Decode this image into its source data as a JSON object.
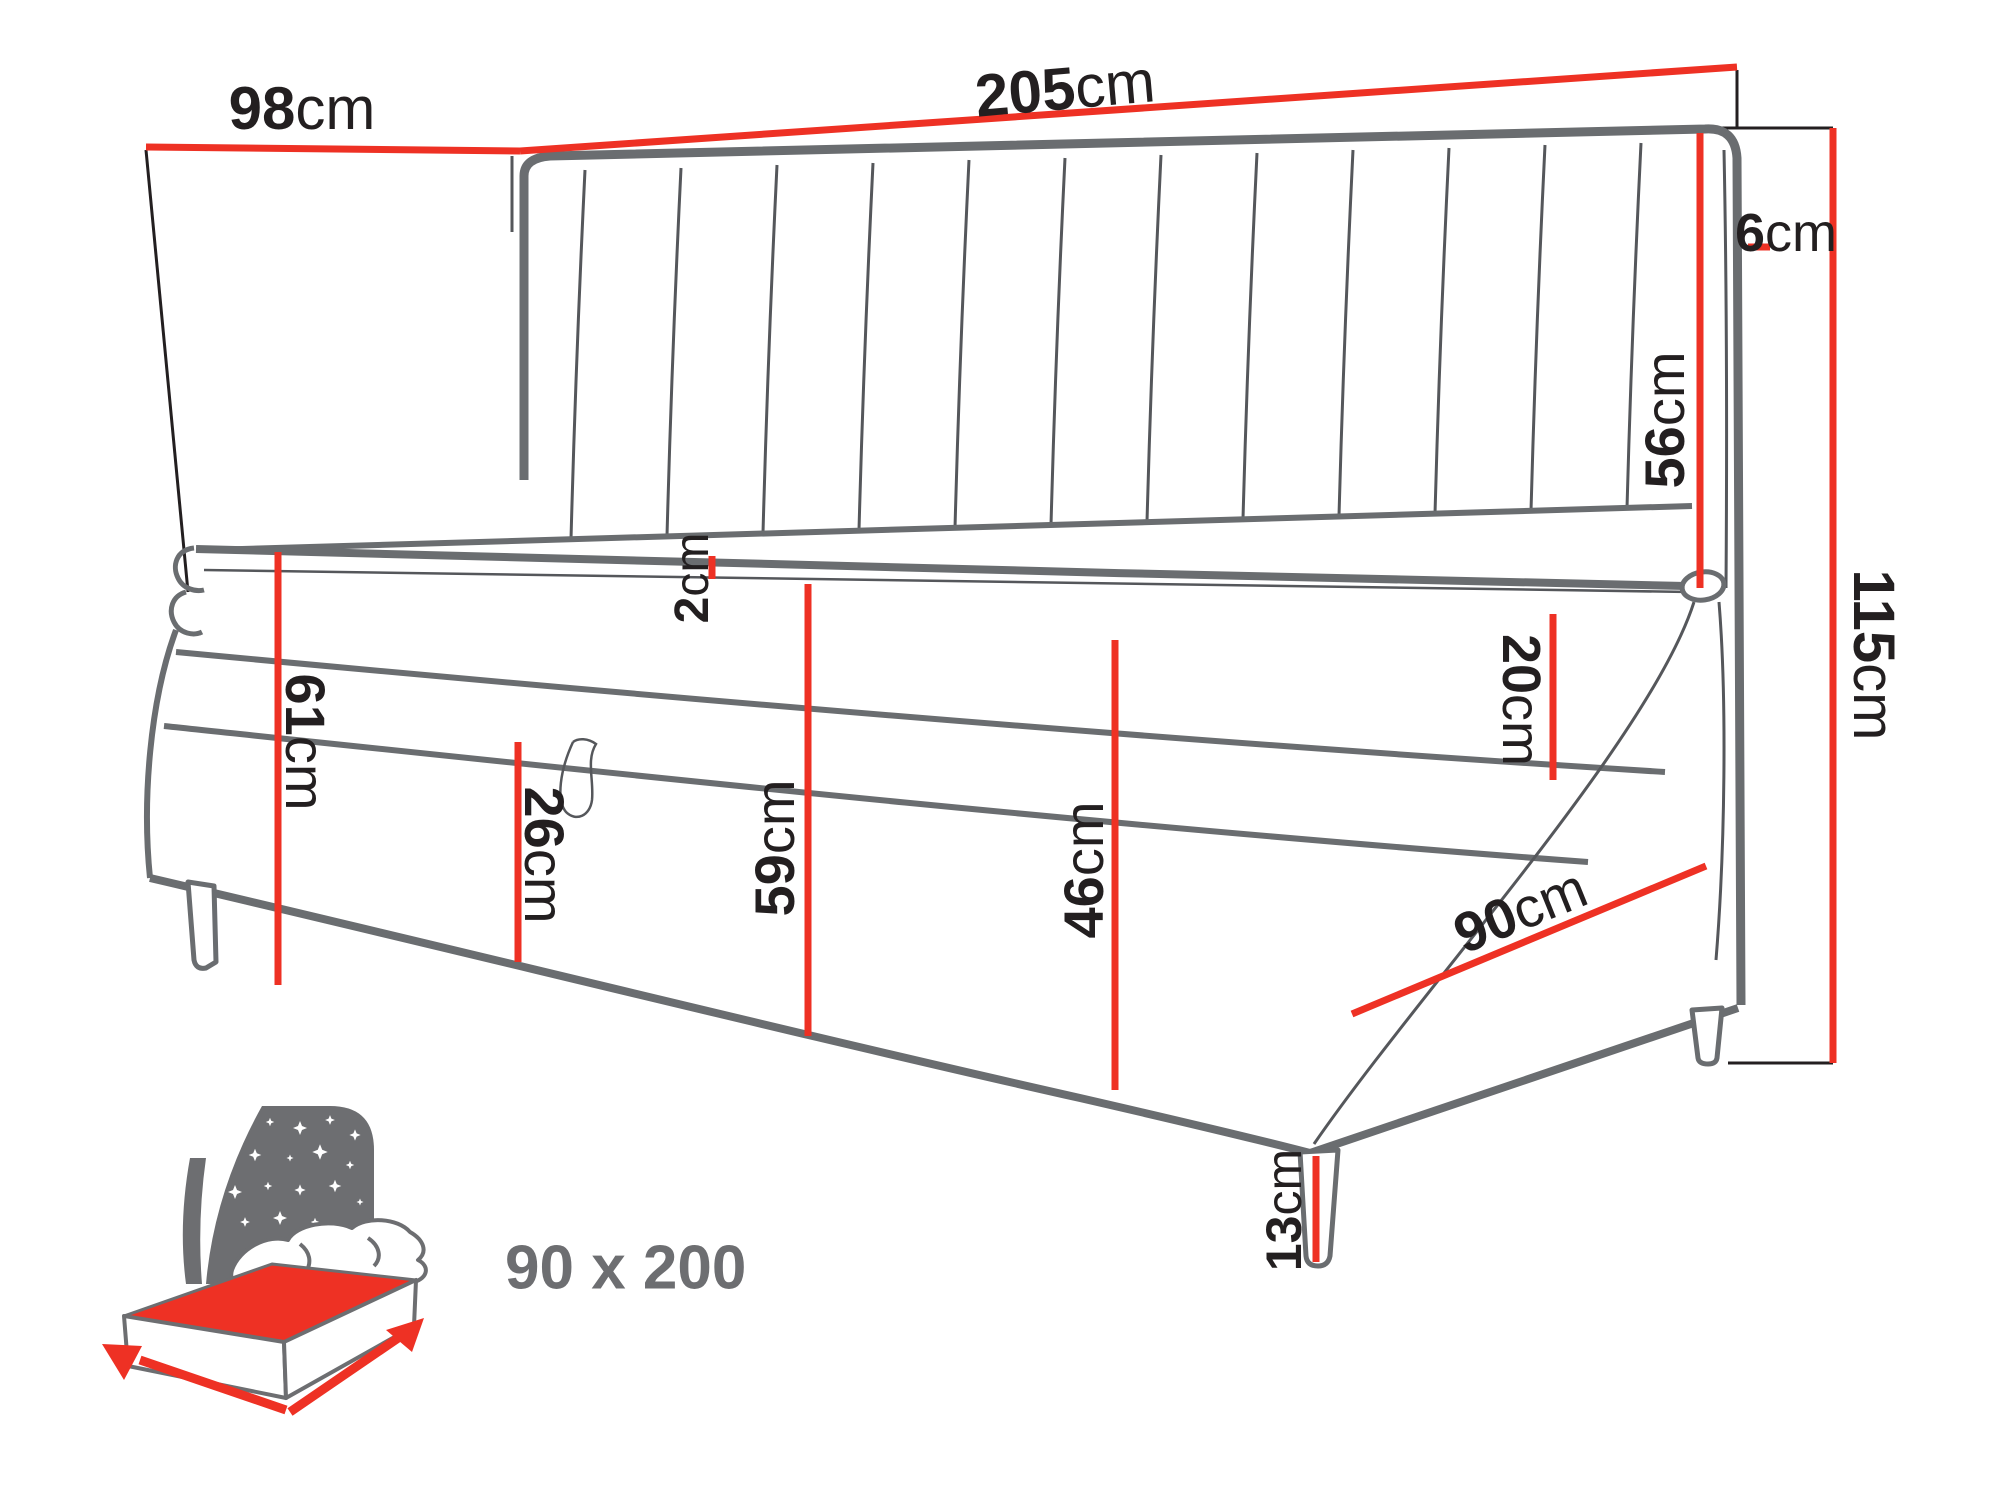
{
  "figure": {
    "title": "Bed dimension diagram",
    "caption": "90 x 200",
    "dimensions": {
      "back_width": {
        "value": "98",
        "unit": "cm"
      },
      "total_length": {
        "value": "205",
        "unit": "cm"
      },
      "headboard_thickness": {
        "value": "6",
        "unit": "cm"
      },
      "headboard_over_mattress": {
        "value": "56",
        "unit": "cm"
      },
      "total_height": {
        "value": "115",
        "unit": "cm"
      },
      "topper_height": {
        "value": "2",
        "unit": "cm"
      },
      "left_end_height": {
        "value": "61",
        "unit": "cm"
      },
      "storage_front_height": {
        "value": "26",
        "unit": "cm"
      },
      "height_without_topper": {
        "value": "59",
        "unit": "cm"
      },
      "base_with_mattress": {
        "value": "46",
        "unit": "cm"
      },
      "mattress_side_height": {
        "value": "20",
        "unit": "cm"
      },
      "side_width": {
        "value": "90",
        "unit": "cm"
      },
      "leg_height": {
        "value": "13",
        "unit": "cm"
      }
    },
    "colors": {
      "accent_red": "#ee3124",
      "furniture_gray": "#6a6d70",
      "seam_gray": "#55575b",
      "text_black": "#231f20",
      "icon_gray": "#6d6e71"
    }
  }
}
